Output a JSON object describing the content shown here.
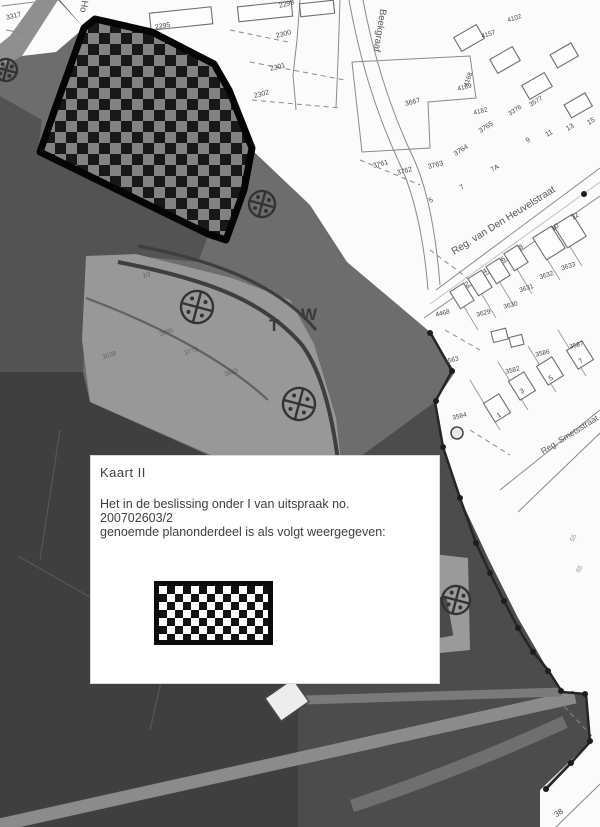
{
  "legend": {
    "title": "Kaart II",
    "line1": "Het in de beslissing onder I van uitspraak no.",
    "line2": "200702603/2",
    "line3": "genoemde planonderdeel is als volgt weergegeven:",
    "swatch_meaning": "checkered-plan-area"
  },
  "map": {
    "colors": {
      "label_ink": "#474747",
      "checker_dark": "#181818",
      "checker_light": "#828282",
      "legend_checker_dark": "#111111",
      "legend_checker_light": "#ffffff",
      "paper_white": "#fbfbfb",
      "urban_gray": "#6d6d6d",
      "dark_area": "#3f3f3f"
    },
    "street_labels": [
      {
        "t": "Beekgraaf",
        "x": 377,
        "y": 30,
        "r": 99,
        "s": 9.5,
        "c": "#565656"
      },
      {
        "t": "Ho",
        "x": 81,
        "y": 6,
        "r": 99,
        "s": 9.5,
        "c": "#565656"
      },
      {
        "t": "Reg. van Den Heuvelstraat",
        "x": 505,
        "y": 223,
        "r": -32,
        "s": 10,
        "c": "#565656"
      },
      {
        "t": "Reg. Smetsstraat",
        "x": 571,
        "y": 437,
        "r": -32,
        "s": 8.5,
        "c": "#565656"
      }
    ],
    "area_letters": [
      {
        "t": "T",
        "x": 274,
        "y": 331,
        "r": 0,
        "s": 17,
        "b": true,
        "c": "#3a3a3a"
      },
      {
        "t": "W",
        "x": 309,
        "y": 320,
        "r": 0,
        "s": 17,
        "b": true,
        "c": "#3a3a3a"
      }
    ],
    "parcel_labels": [
      {
        "t": "3317",
        "x": 14,
        "y": 18,
        "r": -14,
        "s": 7
      },
      {
        "t": "2295",
        "x": 163,
        "y": 28,
        "r": -10,
        "s": 7
      },
      {
        "t": "2299",
        "x": 287,
        "y": 6,
        "r": -14,
        "s": 7
      },
      {
        "t": "2300",
        "x": 284,
        "y": 36,
        "r": -14,
        "s": 7
      },
      {
        "t": "2301",
        "x": 278,
        "y": 69,
        "r": -14,
        "s": 7
      },
      {
        "t": "2302",
        "x": 262,
        "y": 96,
        "r": -14,
        "s": 7
      },
      {
        "t": "3667",
        "x": 413,
        "y": 104,
        "r": -14,
        "s": 7
      },
      {
        "t": "4102",
        "x": 515,
        "y": 20,
        "r": -18,
        "s": 6.5
      },
      {
        "t": "4157",
        "x": 489,
        "y": 36,
        "r": -18,
        "s": 6.5
      },
      {
        "t": "4168",
        "x": 470,
        "y": 80,
        "r": -70,
        "s": 6.5
      },
      {
        "t": "4169",
        "x": 465,
        "y": 89,
        "r": -14,
        "s": 6.5
      },
      {
        "t": "4182",
        "x": 481,
        "y": 113,
        "r": -14,
        "s": 6.5
      },
      {
        "t": "3577",
        "x": 537,
        "y": 103,
        "r": -32,
        "s": 6.5
      },
      {
        "t": "3376",
        "x": 516,
        "y": 112,
        "r": -32,
        "s": 6.5
      },
      {
        "t": "3765",
        "x": 487,
        "y": 129,
        "r": -32,
        "s": 7
      },
      {
        "t": "3764",
        "x": 462,
        "y": 152,
        "r": -32,
        "s": 7
      },
      {
        "t": "3763",
        "x": 436,
        "y": 167,
        "r": -14,
        "s": 7
      },
      {
        "t": "3762",
        "x": 405,
        "y": 173,
        "r": -14,
        "s": 7
      },
      {
        "t": "3761",
        "x": 381,
        "y": 166,
        "r": -14,
        "s": 7
      },
      {
        "t": "7A",
        "x": 496,
        "y": 170,
        "r": -30,
        "s": 7
      },
      {
        "t": "9",
        "x": 529,
        "y": 142,
        "r": -30,
        "s": 7
      },
      {
        "t": "11",
        "x": 550,
        "y": 135,
        "r": -30,
        "s": 7
      },
      {
        "t": "13",
        "x": 571,
        "y": 129,
        "r": -30,
        "s": 7
      },
      {
        "t": "15",
        "x": 592,
        "y": 123,
        "r": -30,
        "s": 7
      },
      {
        "t": "5",
        "x": 432,
        "y": 202,
        "r": -32,
        "s": 7
      },
      {
        "t": "7",
        "x": 463,
        "y": 189,
        "r": -32,
        "s": 7
      },
      {
        "t": "2",
        "x": 468,
        "y": 286,
        "r": -32,
        "s": 7
      },
      {
        "t": "4",
        "x": 486,
        "y": 273,
        "r": -32,
        "s": 7
      },
      {
        "t": "6",
        "x": 504,
        "y": 261,
        "r": -32,
        "s": 7
      },
      {
        "t": "8",
        "x": 522,
        "y": 249,
        "r": -32,
        "s": 7
      },
      {
        "t": "10",
        "x": 556,
        "y": 229,
        "r": -32,
        "s": 7
      },
      {
        "t": "12",
        "x": 576,
        "y": 218,
        "r": -32,
        "s": 7
      },
      {
        "t": "3631",
        "x": 527,
        "y": 290,
        "r": -18,
        "s": 6.5
      },
      {
        "t": "3632",
        "x": 547,
        "y": 277,
        "r": -18,
        "s": 6.5
      },
      {
        "t": "3633",
        "x": 569,
        "y": 268,
        "r": -18,
        "s": 6.5
      },
      {
        "t": "4468",
        "x": 443,
        "y": 315,
        "r": -14,
        "s": 6.5
      },
      {
        "t": "3629",
        "x": 484,
        "y": 315,
        "r": -14,
        "s": 6.5
      },
      {
        "t": "3630",
        "x": 511,
        "y": 307,
        "r": -14,
        "s": 6.5
      },
      {
        "t": "3563",
        "x": 452,
        "y": 362,
        "r": -14,
        "s": 6.5
      },
      {
        "t": "3586",
        "x": 543,
        "y": 355,
        "r": -14,
        "s": 6.5
      },
      {
        "t": "3587",
        "x": 577,
        "y": 347,
        "r": -14,
        "s": 6.5
      },
      {
        "t": "3582",
        "x": 513,
        "y": 372,
        "r": -14,
        "s": 6.5
      },
      {
        "t": "3584",
        "x": 460,
        "y": 418,
        "r": -14,
        "s": 6.5
      },
      {
        "t": "1",
        "x": 500,
        "y": 417,
        "r": -32,
        "s": 7
      },
      {
        "t": "3",
        "x": 523,
        "y": 393,
        "r": -32,
        "s": 7
      },
      {
        "t": "5",
        "x": 552,
        "y": 380,
        "r": -32,
        "s": 7
      },
      {
        "t": "7",
        "x": 582,
        "y": 363,
        "r": -32,
        "s": 7
      },
      {
        "t": "38",
        "x": 560,
        "y": 815,
        "r": -32,
        "s": 8
      },
      {
        "t": "10",
        "x": 147,
        "y": 277,
        "r": -14,
        "s": 7,
        "o": 0.55,
        "c": "#2f2f2f"
      },
      {
        "t": "3095",
        "x": 167,
        "y": 334,
        "r": -18,
        "s": 6.5,
        "o": 0.5,
        "c": "#2f2f2f"
      },
      {
        "t": "3775",
        "x": 192,
        "y": 353,
        "r": -18,
        "s": 6.5,
        "o": 0.5,
        "c": "#2f2f2f"
      },
      {
        "t": "3835",
        "x": 232,
        "y": 374,
        "r": -18,
        "s": 6.5,
        "o": 0.5,
        "c": "#2f2f2f"
      },
      {
        "t": "3038",
        "x": 110,
        "y": 357,
        "r": -18,
        "s": 6.5,
        "o": 0.5,
        "c": "#2f2f2f"
      },
      {
        "t": "55",
        "x": 575,
        "y": 539,
        "r": -60,
        "s": 6.5,
        "o": 0.6
      },
      {
        "t": "65",
        "x": 581,
        "y": 570,
        "r": -60,
        "s": 6.5,
        "o": 0.6
      }
    ],
    "symbols": [
      {
        "type": "quadrant-circle",
        "x": 262,
        "y": 204,
        "r": 13
      },
      {
        "type": "quadrant-circle",
        "x": 197,
        "y": 307,
        "r": 16
      },
      {
        "type": "quadrant-circle",
        "x": 299,
        "y": 404,
        "r": 16
      },
      {
        "type": "quadrant-circle",
        "x": 456,
        "y": 600,
        "r": 14
      },
      {
        "type": "quadrant-circle",
        "x": 6,
        "y": 70,
        "r": 11
      },
      {
        "type": "small-circle",
        "x": 457,
        "y": 433,
        "r": 6
      }
    ]
  }
}
